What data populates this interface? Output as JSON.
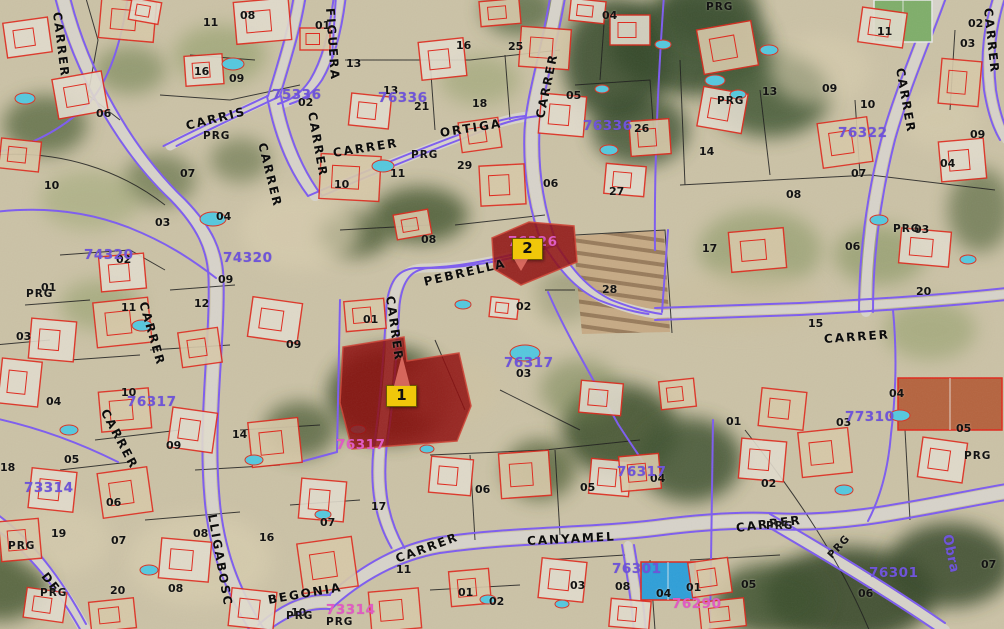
{
  "map": {
    "description": "Cadastral aerial orthophoto with parcel overlay, two highlighted parcels",
    "colors": {
      "highlight_parcel": "#8f0d0d",
      "marker": "#f0c70a",
      "boundary_purple": "#7d5cf0",
      "building_outline": "#e0281c",
      "block_number_purple": "#6f55d8",
      "block_number_pink": "#e05cc2"
    },
    "markers": [
      {
        "label": "1",
        "x": 386,
        "y": 385,
        "pointer": "up"
      },
      {
        "label": "2",
        "x": 512,
        "y": 238,
        "pointer": "down"
      }
    ],
    "highlighted_parcels": [
      {
        "id": "1",
        "points": "343,347 404,337 407,361 459,353 471,406 457,441 352,449 340,403"
      },
      {
        "id": "2",
        "points": "492,238 529,222 574,226 577,262 521,285 494,269"
      }
    ],
    "streets": [
      {
        "t": "CARRER",
        "x": 57,
        "y": 6,
        "r": 83
      },
      {
        "t": "CARRIS",
        "x": 186,
        "y": 120,
        "r": -14
      },
      {
        "t": "CARRER",
        "x": 262,
        "y": 137,
        "r": 76
      },
      {
        "t": "CARRER",
        "x": 312,
        "y": 106,
        "r": 80
      },
      {
        "t": "FIGUERA",
        "x": 330,
        "y": 2,
        "r": 86
      },
      {
        "t": "CARRER",
        "x": 333,
        "y": 147,
        "r": -9
      },
      {
        "t": "ORTIGA",
        "x": 440,
        "y": 127,
        "r": -9
      },
      {
        "t": "CARRER",
        "x": 540,
        "y": 112,
        "r": -78
      },
      {
        "t": "PEBRELLA",
        "x": 424,
        "y": 276,
        "r": -13
      },
      {
        "t": "CARRER",
        "x": 390,
        "y": 290,
        "r": 82
      },
      {
        "t": "CARRER",
        "x": 143,
        "y": 296,
        "r": 74
      },
      {
        "t": "CARRER",
        "x": 104,
        "y": 404,
        "r": 62
      },
      {
        "t": "LLIGABOSC",
        "x": 212,
        "y": 508,
        "r": 80
      },
      {
        "t": "DE",
        "x": 44,
        "y": 568,
        "r": 52
      },
      {
        "t": "BEGONIA",
        "x": 268,
        "y": 594,
        "r": -10
      },
      {
        "t": "CANYAMEL",
        "x": 527,
        "y": 535,
        "r": -3
      },
      {
        "t": "CARRER",
        "x": 396,
        "y": 553,
        "r": -20
      },
      {
        "t": "CARRER",
        "x": 736,
        "y": 522,
        "r": -7
      },
      {
        "t": "CARRER",
        "x": 824,
        "y": 333,
        "r": -4
      },
      {
        "t": "CARRER",
        "x": 900,
        "y": 62,
        "r": 80
      },
      {
        "t": "CARRER",
        "x": 988,
        "y": 2,
        "r": 84
      }
    ],
    "block_numbers": [
      {
        "t": "75336",
        "x": 272,
        "y": 89,
        "c": "purple"
      },
      {
        "t": "76336",
        "x": 378,
        "y": 92,
        "c": "purple"
      },
      {
        "t": "76336",
        "x": 583,
        "y": 120,
        "c": "purple"
      },
      {
        "t": "76322",
        "x": 838,
        "y": 127,
        "c": "purple"
      },
      {
        "t": "74320",
        "x": 84,
        "y": 249,
        "c": "purple"
      },
      {
        "t": "74320",
        "x": 223,
        "y": 252,
        "c": "purple"
      },
      {
        "t": "76326",
        "x": 508,
        "y": 236,
        "c": "pink"
      },
      {
        "t": "76317",
        "x": 504,
        "y": 357,
        "c": "purple"
      },
      {
        "t": "76317",
        "x": 127,
        "y": 396,
        "c": "purple"
      },
      {
        "t": "76317",
        "x": 336,
        "y": 439,
        "c": "pink"
      },
      {
        "t": "76317",
        "x": 617,
        "y": 466,
        "c": "purple"
      },
      {
        "t": "76301",
        "x": 612,
        "y": 563,
        "c": "purple"
      },
      {
        "t": "76301",
        "x": 869,
        "y": 567,
        "c": "purple"
      },
      {
        "t": "73314",
        "x": 24,
        "y": 482,
        "c": "purple"
      },
      {
        "t": "73314",
        "x": 326,
        "y": 604,
        "c": "pink"
      },
      {
        "t": "76290",
        "x": 672,
        "y": 598,
        "c": "pink"
      },
      {
        "t": "77310",
        "x": 845,
        "y": 411,
        "c": "purple"
      },
      {
        "t": "Obra",
        "x": 946,
        "y": 528,
        "c": "purple",
        "r": 78
      }
    ],
    "parcel_numbers": [
      {
        "t": "11",
        "x": 203,
        "y": 17
      },
      {
        "t": "08",
        "x": 240,
        "y": 10
      },
      {
        "t": "01",
        "x": 315,
        "y": 20
      },
      {
        "t": "16",
        "x": 194,
        "y": 66
      },
      {
        "t": "09",
        "x": 229,
        "y": 73
      },
      {
        "t": "06",
        "x": 96,
        "y": 108
      },
      {
        "t": "02",
        "x": 298,
        "y": 97
      },
      {
        "t": "10",
        "x": 44,
        "y": 180
      },
      {
        "t": "07",
        "x": 180,
        "y": 168
      },
      {
        "t": "03",
        "x": 155,
        "y": 217
      },
      {
        "t": "04",
        "x": 216,
        "y": 211
      },
      {
        "t": "13",
        "x": 346,
        "y": 58
      },
      {
        "t": "13",
        "x": 383,
        "y": 85
      },
      {
        "t": "21",
        "x": 414,
        "y": 101
      },
      {
        "t": "18",
        "x": 472,
        "y": 98
      },
      {
        "t": "05",
        "x": 566,
        "y": 90
      },
      {
        "t": "26",
        "x": 634,
        "y": 123
      },
      {
        "t": "29",
        "x": 457,
        "y": 160
      },
      {
        "t": "06",
        "x": 543,
        "y": 178
      },
      {
        "t": "27",
        "x": 609,
        "y": 186
      },
      {
        "t": "10",
        "x": 334,
        "y": 179
      },
      {
        "t": "11",
        "x": 390,
        "y": 168
      },
      {
        "t": "04",
        "x": 602,
        "y": 10
      },
      {
        "t": "25",
        "x": 508,
        "y": 41
      },
      {
        "t": "16",
        "x": 456,
        "y": 40
      },
      {
        "t": "11",
        "x": 877,
        "y": 26
      },
      {
        "t": "02",
        "x": 968,
        "y": 18
      },
      {
        "t": "03",
        "x": 960,
        "y": 38
      },
      {
        "t": "13",
        "x": 762,
        "y": 86
      },
      {
        "t": "09",
        "x": 822,
        "y": 83
      },
      {
        "t": "10",
        "x": 860,
        "y": 99
      },
      {
        "t": "14",
        "x": 699,
        "y": 146
      },
      {
        "t": "04",
        "x": 940,
        "y": 158
      },
      {
        "t": "09",
        "x": 970,
        "y": 129
      },
      {
        "t": "07",
        "x": 851,
        "y": 168
      },
      {
        "t": "08",
        "x": 786,
        "y": 189
      },
      {
        "t": "08",
        "x": 421,
        "y": 234
      },
      {
        "t": "01",
        "x": 363,
        "y": 314
      },
      {
        "t": "02",
        "x": 516,
        "y": 301
      },
      {
        "t": "03",
        "x": 516,
        "y": 368
      },
      {
        "t": "28",
        "x": 602,
        "y": 284
      },
      {
        "t": "02",
        "x": 116,
        "y": 254
      },
      {
        "t": "01",
        "x": 41,
        "y": 282
      },
      {
        "t": "09",
        "x": 218,
        "y": 274
      },
      {
        "t": "11",
        "x": 121,
        "y": 302
      },
      {
        "t": "12",
        "x": 194,
        "y": 298
      },
      {
        "t": "03",
        "x": 16,
        "y": 331
      },
      {
        "t": "09",
        "x": 286,
        "y": 339
      },
      {
        "t": "04",
        "x": 46,
        "y": 396
      },
      {
        "t": "10",
        "x": 121,
        "y": 387
      },
      {
        "t": "17",
        "x": 702,
        "y": 243
      },
      {
        "t": "06",
        "x": 845,
        "y": 241
      },
      {
        "t": "03",
        "x": 914,
        "y": 224
      },
      {
        "t": "20",
        "x": 916,
        "y": 286
      },
      {
        "t": "15",
        "x": 808,
        "y": 318
      },
      {
        "t": "04",
        "x": 889,
        "y": 388
      },
      {
        "t": "01",
        "x": 726,
        "y": 416
      },
      {
        "t": "03",
        "x": 836,
        "y": 417
      },
      {
        "t": "05",
        "x": 956,
        "y": 423
      },
      {
        "t": "18",
        "x": 0,
        "y": 462
      },
      {
        "t": "05",
        "x": 64,
        "y": 454
      },
      {
        "t": "09",
        "x": 166,
        "y": 440
      },
      {
        "t": "14",
        "x": 232,
        "y": 429
      },
      {
        "t": "06",
        "x": 106,
        "y": 497
      },
      {
        "t": "19",
        "x": 51,
        "y": 528
      },
      {
        "t": "07",
        "x": 111,
        "y": 535
      },
      {
        "t": "08",
        "x": 193,
        "y": 528
      },
      {
        "t": "16",
        "x": 259,
        "y": 532
      },
      {
        "t": "07",
        "x": 320,
        "y": 517
      },
      {
        "t": "20",
        "x": 110,
        "y": 585
      },
      {
        "t": "08",
        "x": 168,
        "y": 583
      },
      {
        "t": "10",
        "x": 291,
        "y": 607
      },
      {
        "t": "17",
        "x": 371,
        "y": 501
      },
      {
        "t": "06",
        "x": 475,
        "y": 484
      },
      {
        "t": "05",
        "x": 580,
        "y": 482
      },
      {
        "t": "04",
        "x": 650,
        "y": 473
      },
      {
        "t": "11",
        "x": 396,
        "y": 564
      },
      {
        "t": "01",
        "x": 458,
        "y": 587
      },
      {
        "t": "02",
        "x": 489,
        "y": 596
      },
      {
        "t": "03",
        "x": 570,
        "y": 580
      },
      {
        "t": "08",
        "x": 615,
        "y": 581
      },
      {
        "t": "04",
        "x": 656,
        "y": 588
      },
      {
        "t": "02",
        "x": 761,
        "y": 478
      },
      {
        "t": "06",
        "x": 858,
        "y": 588
      },
      {
        "t": "07",
        "x": 981,
        "y": 559
      },
      {
        "t": "05",
        "x": 741,
        "y": 579
      },
      {
        "t": "01",
        "x": 686,
        "y": 582
      }
    ],
    "land_use_labels": [
      {
        "t": "PRG",
        "x": 203,
        "y": 131
      },
      {
        "t": "PRG",
        "x": 411,
        "y": 150
      },
      {
        "t": "PRG",
        "x": 706,
        "y": 2
      },
      {
        "t": "PRG",
        "x": 717,
        "y": 96
      },
      {
        "t": "PRG",
        "x": 893,
        "y": 224
      },
      {
        "t": "PRG",
        "x": 26,
        "y": 289
      },
      {
        "t": "PRG",
        "x": 8,
        "y": 541
      },
      {
        "t": "PRG",
        "x": 40,
        "y": 588
      },
      {
        "t": "PRG",
        "x": 326,
        "y": 617
      },
      {
        "t": "PRG",
        "x": 766,
        "y": 521
      },
      {
        "t": "PRG",
        "x": 964,
        "y": 451
      },
      {
        "t": "PRG",
        "x": 830,
        "y": 552,
        "r": -48
      },
      {
        "t": "PRG",
        "x": 286,
        "y": 611
      }
    ]
  }
}
